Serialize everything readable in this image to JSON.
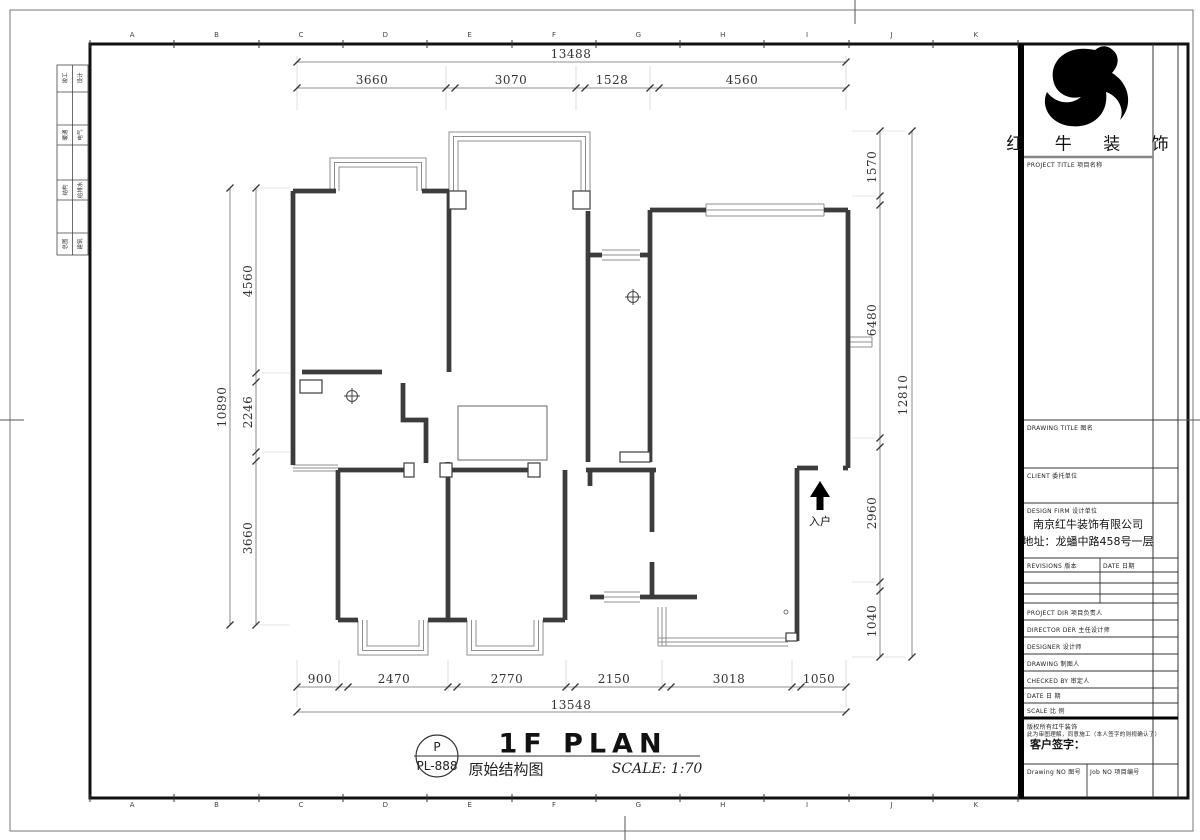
{
  "sheet": {
    "code_top": "P",
    "code_bottom": "PL-888",
    "title_en": "1F PLAN",
    "title_cn": "原始结构图",
    "scale": "SCALE: 1:70"
  },
  "dimensions": {
    "top": {
      "total": "13488",
      "segments": [
        "3660",
        "3070",
        "1528",
        "4560"
      ]
    },
    "bottom": {
      "total": "13548",
      "segments": [
        "900",
        "2470",
        "2770",
        "2150",
        "3018",
        "1050"
      ]
    },
    "left": {
      "total": "10890",
      "segments": [
        "4560",
        "2246",
        "3660"
      ]
    },
    "right": {
      "total": "12810",
      "segments": [
        "1570",
        "6480",
        "2960",
        "1040"
      ]
    }
  },
  "plan": {
    "entrance_label": "入户"
  },
  "frame": {
    "ruler_letters": [
      "A",
      "B",
      "C",
      "D",
      "E",
      "F",
      "G",
      "H",
      "I",
      "J",
      "K"
    ]
  },
  "left_table": {
    "rows": [
      [
        "竣工",
        "设计"
      ],
      [
        "暖通",
        "电气"
      ],
      [
        "结构",
        "给排水"
      ],
      [
        "总图",
        "建筑"
      ]
    ]
  },
  "titleblock": {
    "brand": "红 牛 装 饰",
    "project_title_label": "PROJECT TITLE 项目名称",
    "drawing_title_label": "DRAWING TITLE 图名",
    "client_label": "CLIENT 委托单位",
    "design_firm_label": "DESIGN FIRM 设计单位",
    "firm_name": "南京红牛装饰有限公司",
    "firm_address": "地址：龙蟠中路458号一层",
    "revisions_label": "REVISIONS 版本",
    "date_col_label": "DATE 日期",
    "staff_rows": [
      "PROJECT DIR  项目负责人",
      "DIRECTOR DER 主任设计师",
      "DESIGNER  设计师",
      "DRAWING  制图人",
      "CHECKED BY  审定人",
      "DATE  日 期",
      "SCALE  比 例"
    ],
    "copyright_line1": "版权所有红牛装饰",
    "copyright_line2": "此为审图理解，同意施工（本人签字的则视确认了）",
    "signature_label": "客户签字：",
    "drawing_no_label": "Drawing NO 图号",
    "job_no_label": "Job NO 项目编号"
  },
  "colors": {
    "wall": "#3c3c3c",
    "window": "#8f8f8f",
    "dim_line": "#6b6b6b",
    "text": "#2e2e2e",
    "frame": "#111111"
  }
}
